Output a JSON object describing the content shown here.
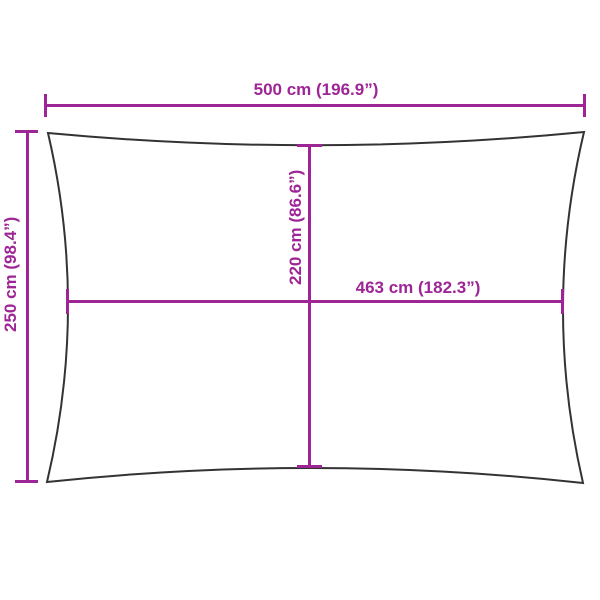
{
  "diagram": {
    "type": "product-dimension-diagram",
    "subject": "rectangular shade sail outline with concave edges",
    "colors": {
      "dimension_lines": "#9e2596",
      "outline": "#333333",
      "background": "#ffffff"
    },
    "dimensions": {
      "outer_width": {
        "cm": 500,
        "inch": 196.9,
        "label": "500 cm (196.9”)"
      },
      "outer_height": {
        "cm": 250,
        "inch": 98.4,
        "label": "250 cm (98.4”)"
      },
      "inner_width": {
        "cm": 463,
        "inch": 182.3,
        "label": "463 cm (182.3”)"
      },
      "inner_height": {
        "cm": 220,
        "inch": 86.6,
        "label": "220 cm (86.6”)"
      }
    }
  }
}
